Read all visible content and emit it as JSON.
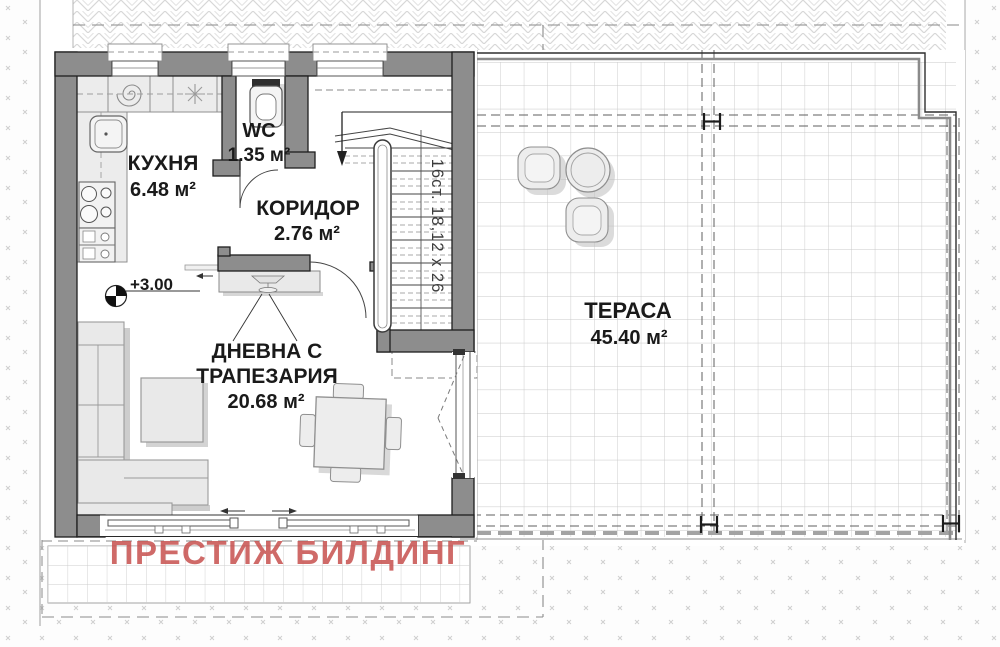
{
  "plan": {
    "rooms": {
      "kitchen": {
        "name": "КУХНЯ",
        "area": "6.48 м²"
      },
      "wc": {
        "name": "WC",
        "area": "1.35 м²"
      },
      "corridor": {
        "name": "КОРИДОР",
        "area": "2.76 м²"
      },
      "living": {
        "name_line1": "ДНЕВНА С",
        "name_line2": "ТРАПЕЗАРИЯ",
        "area": "20.68 м²"
      },
      "terrace": {
        "name": "ТЕРАСА",
        "area": "45.40 м²"
      }
    },
    "annotations": {
      "elevation": "+3.00",
      "stairs_label": "16ст. 18,12 x 26",
      "watermark": "ПРЕСТИЖ БИЛДИНГ"
    },
    "colors": {
      "wall": "#8d8d8d",
      "watermark": "#c7504d",
      "terrace_grid": "#c8c8c8",
      "furniture": "#ececec"
    }
  }
}
